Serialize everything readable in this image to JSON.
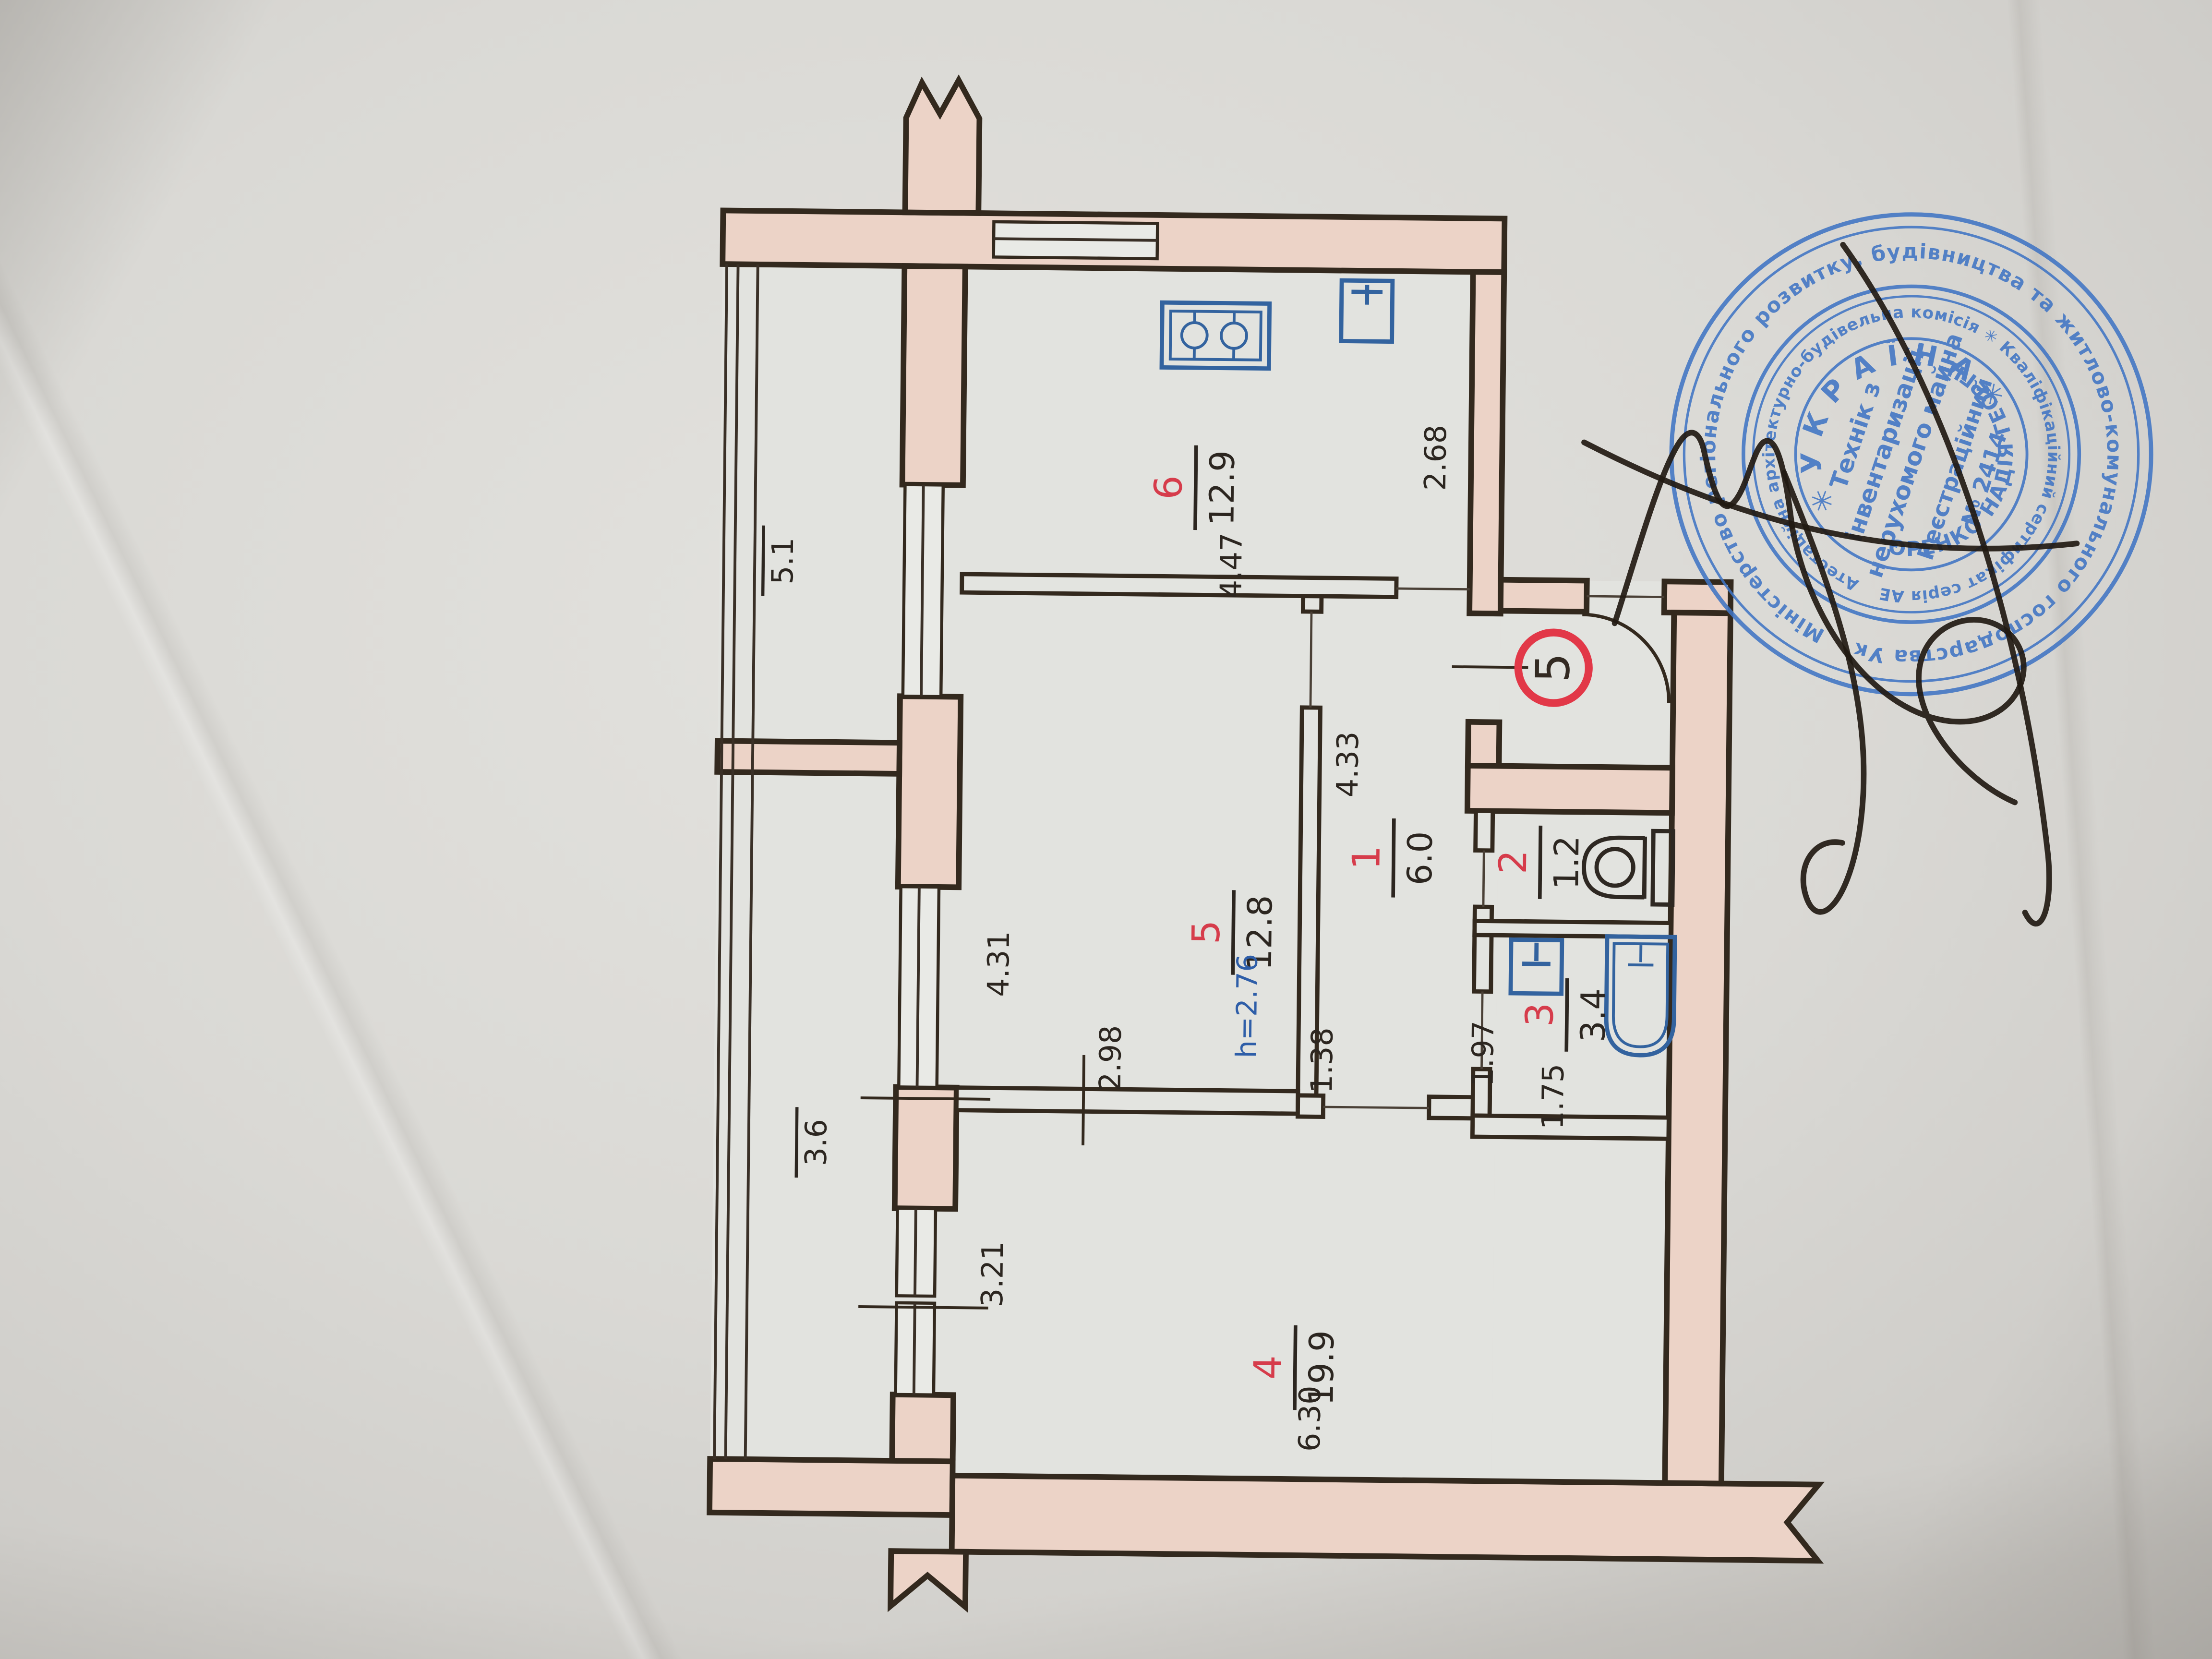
{
  "plan": {
    "apartment_number_badge": "5",
    "rooms": [
      {
        "number": "6",
        "area": "12.9"
      },
      {
        "number": "5",
        "area": "12.8",
        "height_note": "h=2.76"
      },
      {
        "number": "1",
        "area": "6.0"
      },
      {
        "number": "2",
        "area": "1.2"
      },
      {
        "number": "3",
        "area": "3.4"
      },
      {
        "number": "4",
        "area": "19.9"
      }
    ],
    "balcony_areas": [
      "5.1",
      "3.6"
    ],
    "dimensions": {
      "kitchen_width": "4.47",
      "kitchen_depth": "2.68",
      "room5_depth": "4.31",
      "room5_width": "2.98",
      "hall_depth": "4.33",
      "hall_width": "1.38",
      "bath_depth": "1.97",
      "bath_width": "1.75",
      "room4_left": "3.21",
      "room4_bottom": "6.30"
    },
    "colors": {
      "wall_fill": "#ecd3c7",
      "line": "#33291e",
      "room_number_red": "#d63c4b",
      "fixture_blue": "#33639f",
      "stamp_blue": "#3f74c4"
    }
  },
  "stamp": {
    "outer_ring": "Міністерство регіонального розвитку, будівництва та житлово-комунального господарства України ✳",
    "middle_ring": "Атестаційна архітектурно-будівельна комісія ✳ Кваліфікаційний сертифікат серія АЕ №002531",
    "country": "✳УКРАЇНА✳",
    "name": "СИДОРЕНКО НАДІЯ ГЕОРГІЇВНА",
    "title_lines": [
      "Технік з",
      "інвентаризації",
      "нерухомого майна"
    ],
    "reg_lines": [
      "Реєстраційний",
      "№ 2414"
    ]
  }
}
